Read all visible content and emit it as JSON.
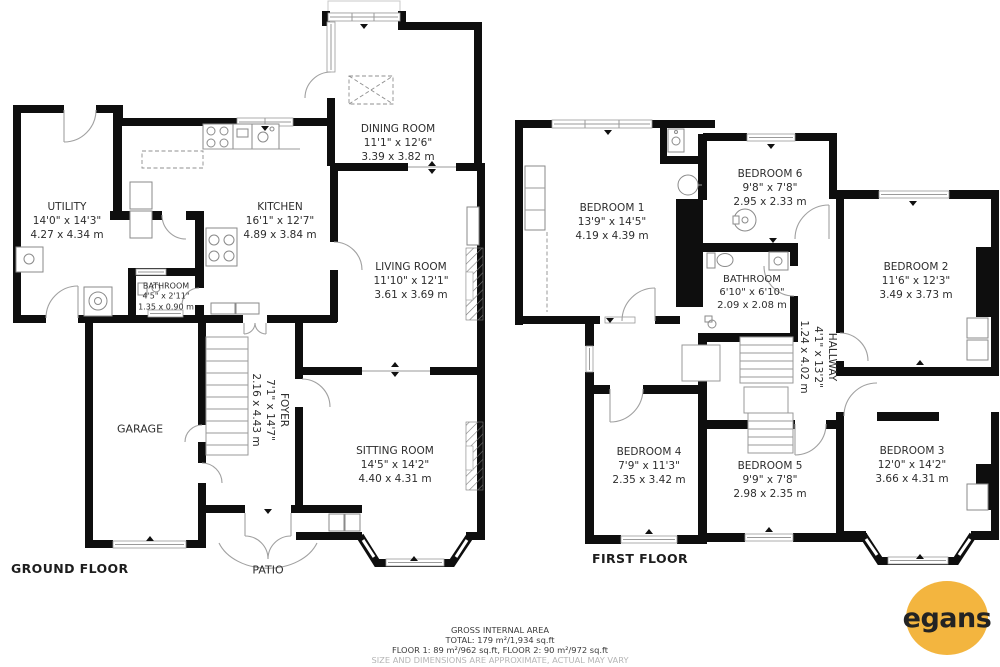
{
  "floors": [
    {
      "name": "GROUND FLOOR",
      "rooms": [
        {
          "name": "UTILITY",
          "imperial": "14'0\" x 14'3\"",
          "metric": "4.27 x 4.34 m"
        },
        {
          "name": "KITCHEN",
          "imperial": "16'1\" x 12'7\"",
          "metric": "4.89 x 3.84 m"
        },
        {
          "name": "BATHROOM",
          "imperial": "4'5\" x 2'11\"",
          "metric": "1.35 x 0.90 m"
        },
        {
          "name": "DINING ROOM",
          "imperial": "11'1\" x 12'6\"",
          "metric": "3.39 x 3.82 m"
        },
        {
          "name": "LIVING ROOM",
          "imperial": "11'10\" x 12'1\"",
          "metric": "3.61 x 3.69 m"
        },
        {
          "name": "FOYER",
          "imperial": "7'1\" x 14'7\"",
          "metric": "2.16 x 4.43 m"
        },
        {
          "name": "SITTING ROOM",
          "imperial": "14'5\" x 14'2\"",
          "metric": "4.40 x 4.31 m"
        }
      ],
      "areas": [
        {
          "label": "GARAGE"
        },
        {
          "label": "PATIO"
        }
      ]
    },
    {
      "name": "FIRST FLOOR",
      "rooms": [
        {
          "name": "BEDROOM 1",
          "imperial": "13'9\" x 14'5\"",
          "metric": "4.19 x 4.39 m"
        },
        {
          "name": "BEDROOM 6",
          "imperial": "9'8\" x 7'8\"",
          "metric": "2.95 x 2.33 m"
        },
        {
          "name": "BATHROOM",
          "imperial": "6'10\" x 6'10\"",
          "metric": "2.09 x 2.08 m"
        },
        {
          "name": "HALLWAY",
          "imperial": "4'1\" x 13'2\"",
          "metric": "1.24 x 4.02 m"
        },
        {
          "name": "BEDROOM 2",
          "imperial": "11'6\" x 12'3\"",
          "metric": "3.49 x 3.73 m"
        },
        {
          "name": "BEDROOM 4",
          "imperial": "7'9\" x 11'3\"",
          "metric": "2.35 x 3.42 m"
        },
        {
          "name": "BEDROOM 5",
          "imperial": "9'9\" x 7'8\"",
          "metric": "2.98 x 2.35 m"
        },
        {
          "name": "BEDROOM 3",
          "imperial": "12'0\" x 14'2\"",
          "metric": "3.66 x 4.31 m"
        }
      ]
    }
  ],
  "footer": {
    "line1": "GROSS INTERNAL AREA",
    "line2": "TOTAL: 179 m²/1,934 sq.ft",
    "line3": "FLOOR 1: 89 m²/962 sq.ft, FLOOR 2: 90 m²/972 sq.ft",
    "line4": "SIZE AND DIMENSIONS ARE APPROXIMATE, ACTUAL MAY VARY"
  },
  "logo": {
    "text": "egans",
    "bg": "#F3B53F"
  },
  "colors": {
    "wall": "#0e0e0e",
    "line": "#9a9a9a",
    "text": "#2d2d2d",
    "footer_muted": "#b5b5b5",
    "accent": "#F3B53F"
  }
}
